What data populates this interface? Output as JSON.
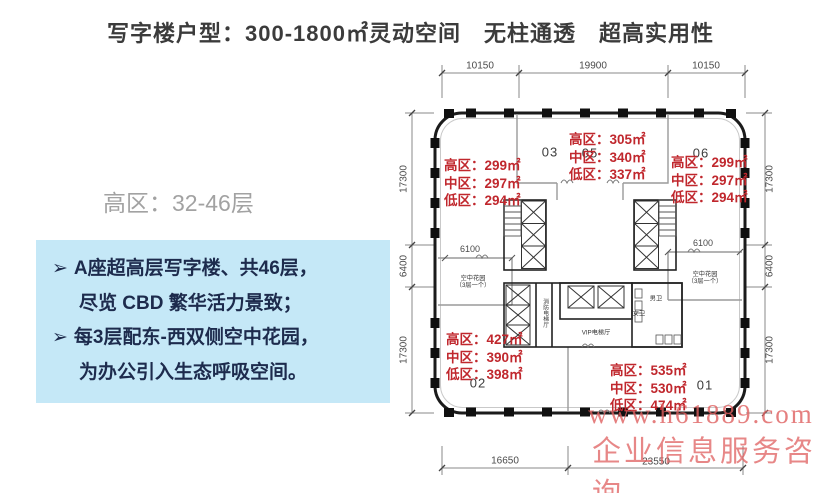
{
  "title": "写字楼户型：300-1800㎡灵动空间　无柱通透　超高实用性",
  "zones": {
    "rows": [
      "高区：32-46层",
      "中区：16-30层",
      "低区：  3-14层"
    ]
  },
  "highlights": {
    "bullet": "➢",
    "items": [
      {
        "line1": "A座超高层写字楼、共46层，",
        "line2": "尽览 CBD 繁华活力景致；"
      },
      {
        "line1": "每3层配东-西双侧空中花园，",
        "line2": "为办公引入生态呼吸空间。"
      }
    ]
  },
  "floor_plan": {
    "units": [
      {
        "id": "03",
        "rows": [
          "高区：299㎡",
          "中区：297㎡",
          "低区：294㎡"
        ]
      },
      {
        "id": "05",
        "rows": [
          "高区：305㎡",
          "中区：340㎡",
          "低区：337㎡"
        ]
      },
      {
        "id": "06",
        "rows": [
          "高区：299㎡",
          "中区：297㎡",
          "低区：294㎡"
        ]
      },
      {
        "id": "02",
        "rows": [
          "高区：427㎡",
          "中区：390㎡",
          "低区：398㎡"
        ]
      },
      {
        "id": "01",
        "rows": [
          "高区：535㎡",
          "中区：530㎡",
          "低区：474㎡"
        ]
      }
    ],
    "dimensions": {
      "top": [
        "10150",
        "19900",
        "10150"
      ],
      "bottom": [
        "16650",
        "23550"
      ],
      "left": [
        "17300",
        "6400",
        "17300"
      ],
      "right": [
        "17300",
        "6400",
        "17300"
      ],
      "garden_width": "6100"
    },
    "labels": {
      "sky_garden_line1": "空中花园",
      "sky_garden_line2": "（3层一个）",
      "vip_lobby": "VIP电梯厅",
      "fire_lobby": "消防电梯厅",
      "restroom_m": "男卫",
      "restroom_f": "女卫"
    }
  },
  "watermark": {
    "line1": "www.h61889.com",
    "line2": "企业信息服务咨询"
  },
  "colors": {
    "accent_red": "#c0272d",
    "highlight_bg": "#c5e8f7",
    "highlight_text": "#1d2b4d",
    "zone_gray": "#a2a2a2",
    "watermark_pink": "#df5f5f"
  }
}
